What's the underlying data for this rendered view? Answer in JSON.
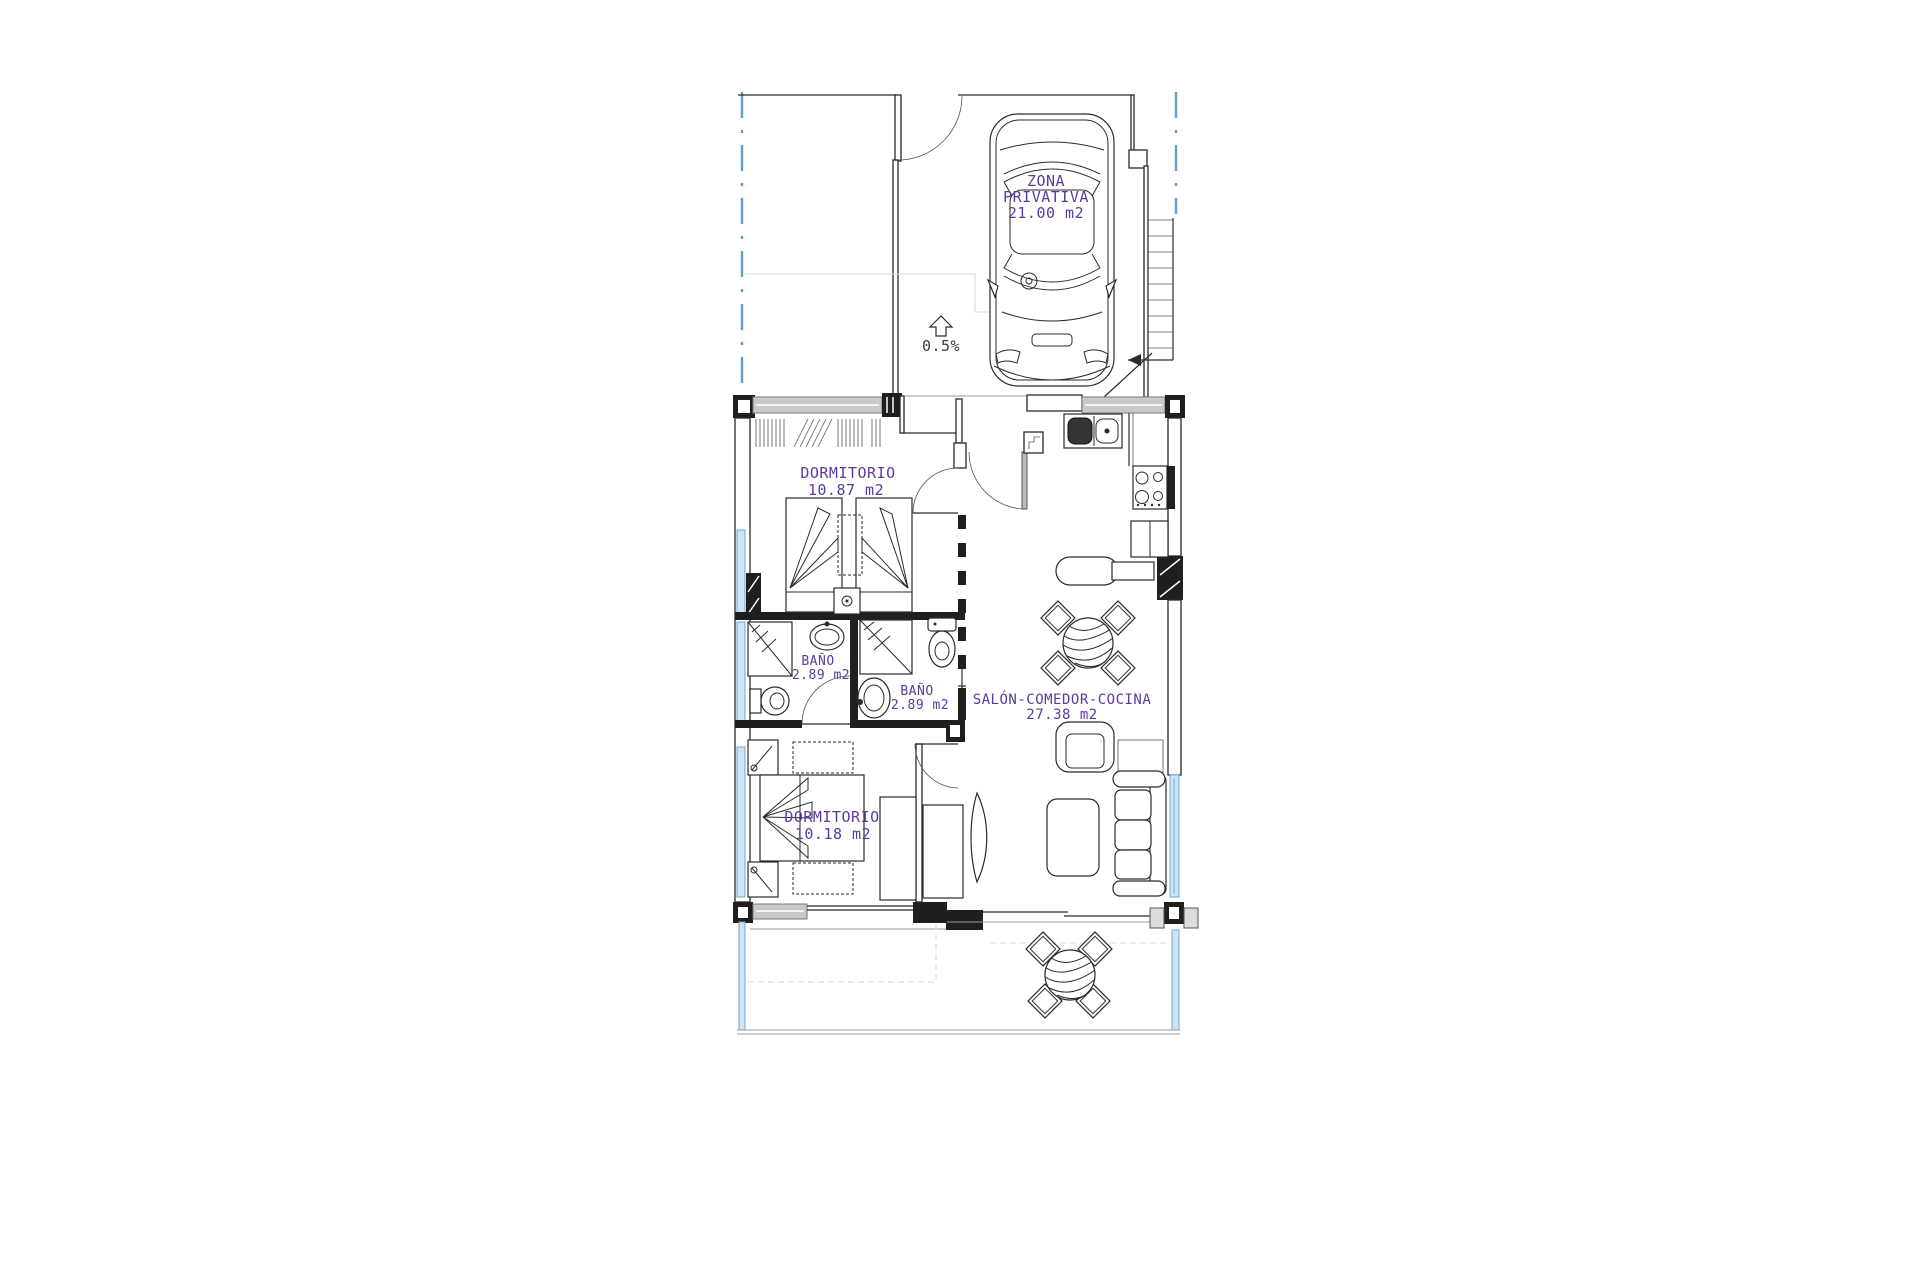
{
  "plan": {
    "type": "apartment-floor-plan",
    "colors": {
      "label_purple": "#5c3a9e",
      "line_dark": "#2a2a2a",
      "window_grey": "#c9c9c9",
      "glazing_blue": "#cfe3f2",
      "boundary_blue": "#5f9fd0"
    },
    "labels": {
      "zona_privativa": {
        "line1": "ZONA",
        "line2": "PRIVATIVA",
        "area": "21.00  m2"
      },
      "slope": {
        "value": "0.5%"
      },
      "dormitorio_1": {
        "name": "DORMITORIO",
        "area": "10.87  m2"
      },
      "bano_1": {
        "name": "BAÑO",
        "area": "2.89  m2"
      },
      "bano_2": {
        "name": "BAÑO",
        "area": "2.89  m2"
      },
      "salon": {
        "name": "SALÓN-COMEDOR-COCINA",
        "area": "27.38  m2"
      },
      "dormitorio_2": {
        "name": "DORMITORIO",
        "area": "10.18  m2"
      }
    },
    "rooms": [
      {
        "name": "ZONA PRIVATIVA",
        "area_m2": "21.00"
      },
      {
        "name": "DORMITORIO",
        "area_m2": "10.87"
      },
      {
        "name": "BAÑO",
        "area_m2": "2.89"
      },
      {
        "name": "BAÑO",
        "area_m2": "2.89"
      },
      {
        "name": "SALÓN-COMEDOR-COCINA",
        "area_m2": "27.38"
      },
      {
        "name": "DORMITORIO",
        "area_m2": "10.18"
      }
    ]
  }
}
